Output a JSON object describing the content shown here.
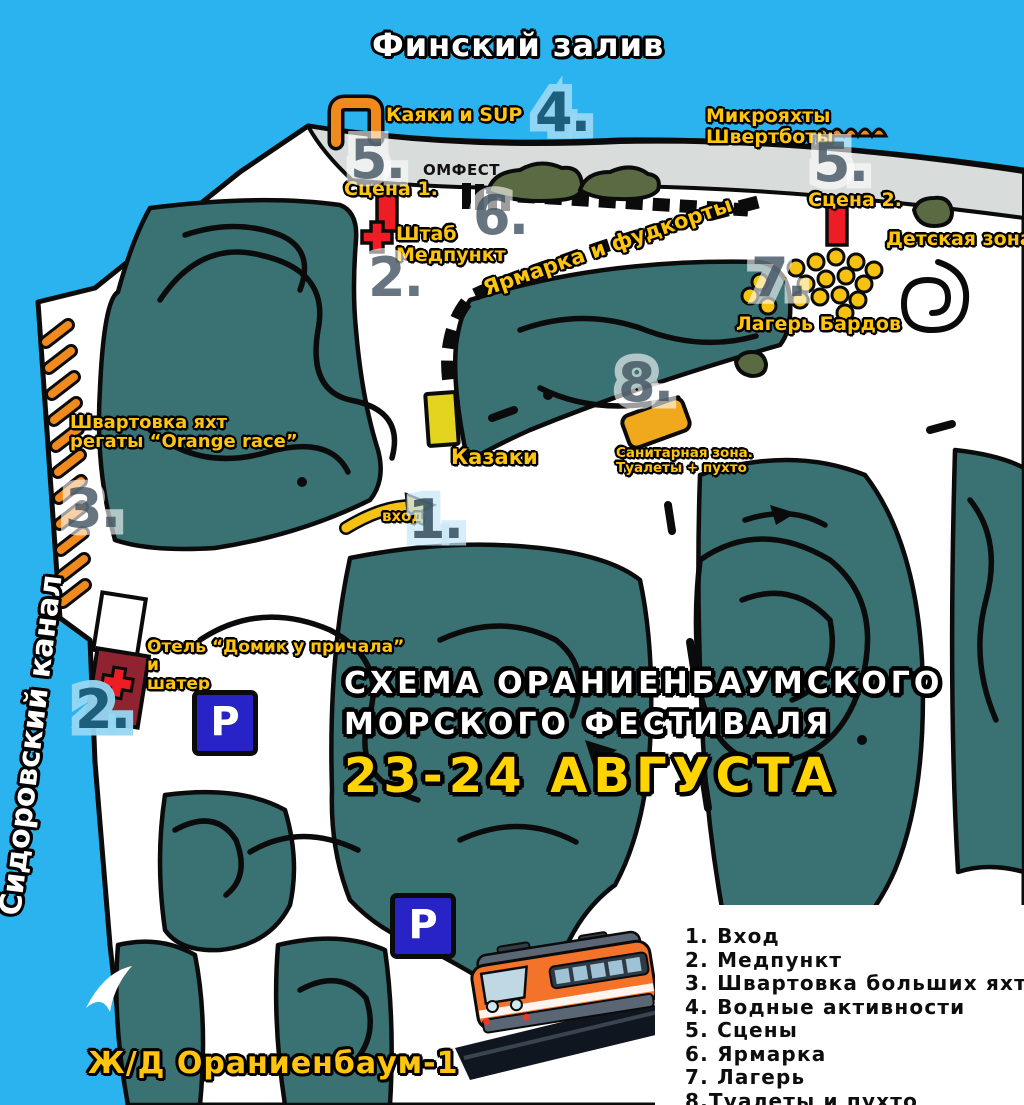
{
  "colors": {
    "water": "#2AB3EF",
    "park_teal": "#3A7173",
    "beach_gray": "#D8DCDB",
    "path_white": "#FFFFFF",
    "outline_black": "#111111",
    "label_yellow": "#FFC40E",
    "accent_orange": "#F08A1D",
    "stage_red": "#EE1C25",
    "hotel_dark_red": "#8F2430",
    "parking_blue": "#2823C6",
    "tent_yellow": "#F6C211",
    "badge_blue": "#9ED9F3",
    "date_yellow": "#FFD400"
  },
  "water": {
    "gulf": "Финский залив",
    "canal": "Сидоровский канал"
  },
  "title": {
    "line1": "СХЕМА ОРАНИЕНБАУМСКОГО",
    "line2": "МОРСКОГО ФЕСТИВАЛЯ",
    "dates": "23-24 АВГУСТА"
  },
  "badges": {
    "b1": "1.",
    "b2": "2.",
    "b3": "3.",
    "b4": "4.",
    "b5": "5.",
    "b6": "6.",
    "b7": "7.",
    "b8": "8."
  },
  "poi": {
    "kayaks": "Каяки и SUP",
    "micro1": "Микрояхты",
    "micro2": "Швертботы",
    "omfest": "ОМФЕСТ",
    "stage1": "Сцена 1.",
    "stage2": "Сцена 2.",
    "hq1": "Штаб",
    "hq2": "Медпункт",
    "fair": "Ярмарка и фудкорты",
    "kids": "Детская зона",
    "bards": "Лагерь Бардов",
    "cossacks": "Казаки",
    "sanitary1": "Санитарная зона.",
    "sanitary2": "Туалеты + пухто",
    "mooring1": "Швартовка яхт",
    "mooring2": "регаты “Orange race”",
    "hotel1": "Отель “Домик у причала”",
    "hotel2": "и",
    "hotel3": "шатер",
    "entrance": "вход",
    "railway": "Ж/Д Ораниенбаум-1",
    "parking": "P"
  },
  "legend": {
    "items": [
      "1. Вход",
      "2. Медпункт",
      "3. Швартовка больших яхт",
      "4. Водные активности",
      "5. Сцены",
      "6. Ярмарка",
      "7. Лагерь",
      "8.Туалеты и пухто"
    ]
  }
}
